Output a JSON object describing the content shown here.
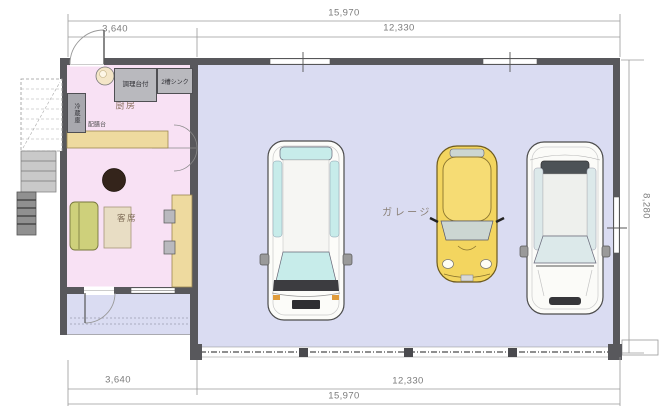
{
  "plan": {
    "rooms": {
      "kitchen": "厨房",
      "seating": "客席",
      "garage": "ガレージ"
    },
    "fixtures": {
      "prep_counter": "調理台付",
      "sink": "2槽シンク",
      "refrigerator": "冷蔵庫",
      "serving_counter": "配膳台"
    },
    "dimensions": {
      "top_total": "15,970",
      "top_left": "3,640",
      "top_right": "12,330",
      "bottom_left": "3,640",
      "bottom_right": "12,330",
      "bottom_total": "15,970",
      "right_height": "8,280"
    },
    "colors": {
      "room_pink": "#f8e1f4",
      "garage_lavender": "#dadcf2",
      "wall": "#58585c",
      "counter_tan": "#eeda9f",
      "sofa_green": "#ced07b",
      "round_table_brown": "#34241b",
      "car_yellow": "#f3d55f",
      "glass_cyan": "#c7ecea",
      "glass_gray": "#dce9ea",
      "windshield_gray": "#ccd6d2"
    }
  }
}
